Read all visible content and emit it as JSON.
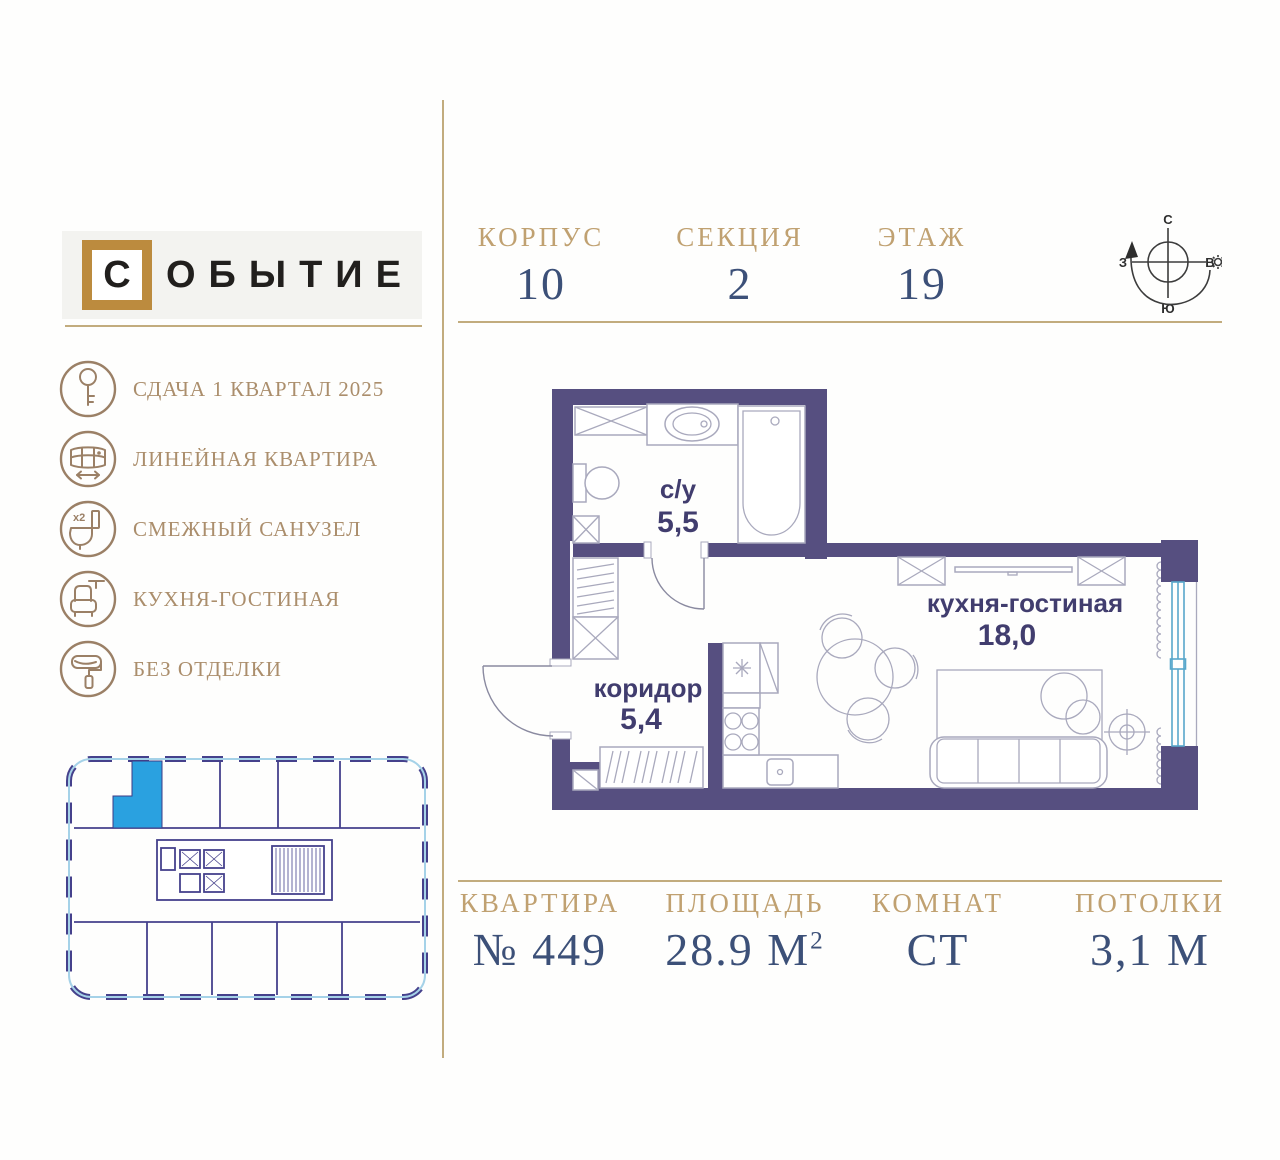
{
  "logo": {
    "mark": "С",
    "rest": "ОБЫТИЕ"
  },
  "header": {
    "fields": [
      {
        "label": "КОРПУС",
        "value": "10"
      },
      {
        "label": "СЕКЦИЯ",
        "value": "2"
      },
      {
        "label": "ЭТАЖ",
        "value": "19"
      }
    ],
    "compass": {
      "north": "С",
      "south": "Ю",
      "west": "З",
      "east": "В"
    }
  },
  "features": [
    {
      "icon": "key-icon",
      "label": "СДАЧА 1 КВАРТАЛ 2025"
    },
    {
      "icon": "panorama-window-icon",
      "label": "ЛИНЕЙНАЯ КВАРТИРА"
    },
    {
      "icon": "toilet-x2-icon",
      "label": "СМЕЖНЫЙ САНУЗЕЛ",
      "badge": "x2"
    },
    {
      "icon": "armchair-icon",
      "label": "КУХНЯ-ГОСТИНАЯ"
    },
    {
      "icon": "paint-roller-icon",
      "label": "БЕЗ ОТДЕЛКИ"
    }
  ],
  "floorplan": {
    "rooms": [
      {
        "name": "с/у",
        "area": "5,5"
      },
      {
        "name": "коридор",
        "area": "5,4"
      },
      {
        "name": "кухня-гостиная",
        "area": "18,0"
      }
    ]
  },
  "stats": [
    {
      "label": "КВАРТИРА",
      "value": "№ 449"
    },
    {
      "label": "ПЛОЩАДЬ",
      "value": "28.9 М",
      "sup": "2"
    },
    {
      "label": "КОМНАТ",
      "value": "СТ"
    },
    {
      "label": "ПОТОЛКИ",
      "value": "3,1 М"
    }
  ],
  "colors": {
    "gold": "#c0a171",
    "navy": "#3c5078",
    "wall": "#564f80",
    "plan_label": "#413d6e",
    "window": "#58a7cb",
    "highlight_unit": "#2aa1e0",
    "mini_wall": "#45418c",
    "logo_frame": "#bc8b3e",
    "icon": "#9b8066",
    "divider_line": "#c2ac7e"
  }
}
